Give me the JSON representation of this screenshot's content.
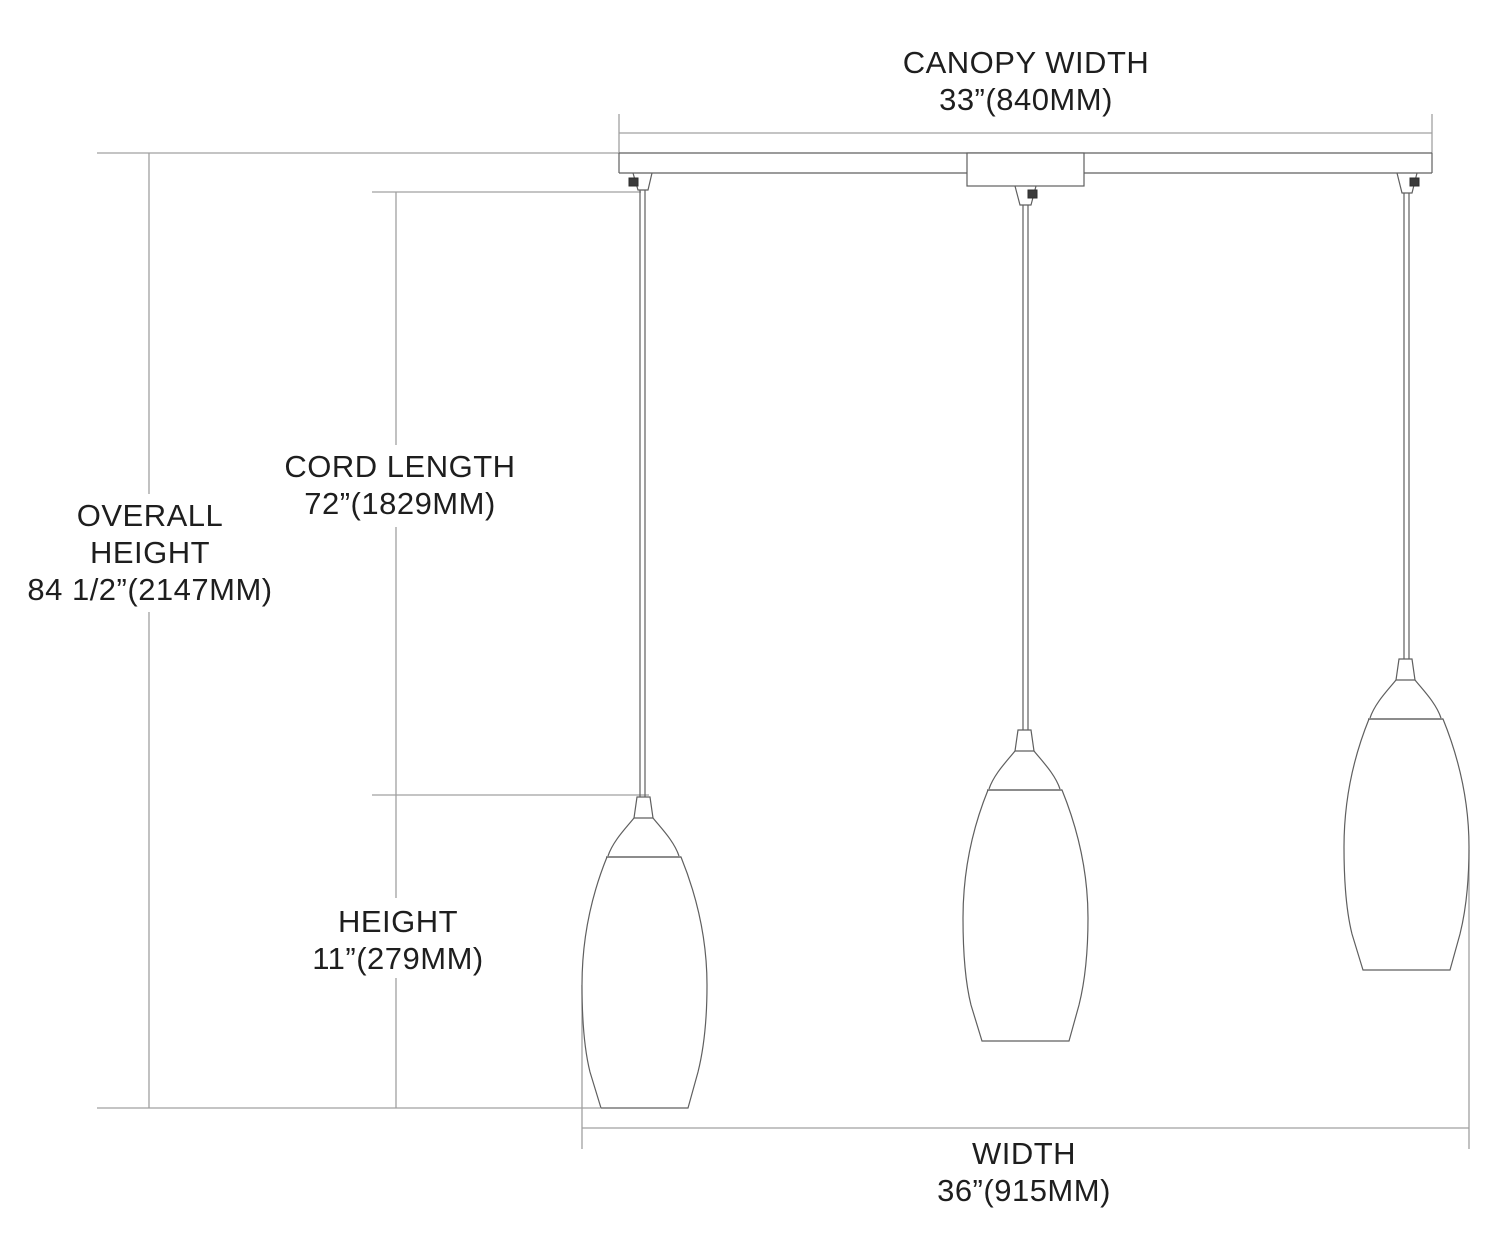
{
  "title": "Pendant fixture dimension diagram",
  "labels": {
    "canopy_width": {
      "lines": [
        "CANOPY WIDTH",
        "33”(840MM)"
      ]
    },
    "overall_height": {
      "lines": [
        "OVERALL",
        "HEIGHT",
        "84 1/2”(2147MM)"
      ]
    },
    "cord_length": {
      "lines": [
        "CORD LENGTH",
        "72”(1829MM)"
      ]
    },
    "height": {
      "lines": [
        "HEIGHT",
        "11”(279MM)"
      ]
    },
    "width": {
      "lines": [
        "WIDTH",
        "36”(915MM)"
      ]
    }
  },
  "measurements": {
    "canopy_width": "33”(840MM)",
    "overall_height": "84 1/2”(2147MM)",
    "cord_length": "72”(1829MM)",
    "pendant_height": "11”(279MM)",
    "width": "36”(915MM)"
  },
  "colors": {
    "background": "#ffffff",
    "text": "#1e1e1e",
    "dimension_line": "#a0a0a0",
    "object_line": "#5f5f5f",
    "screw": "#2e2e2e"
  }
}
